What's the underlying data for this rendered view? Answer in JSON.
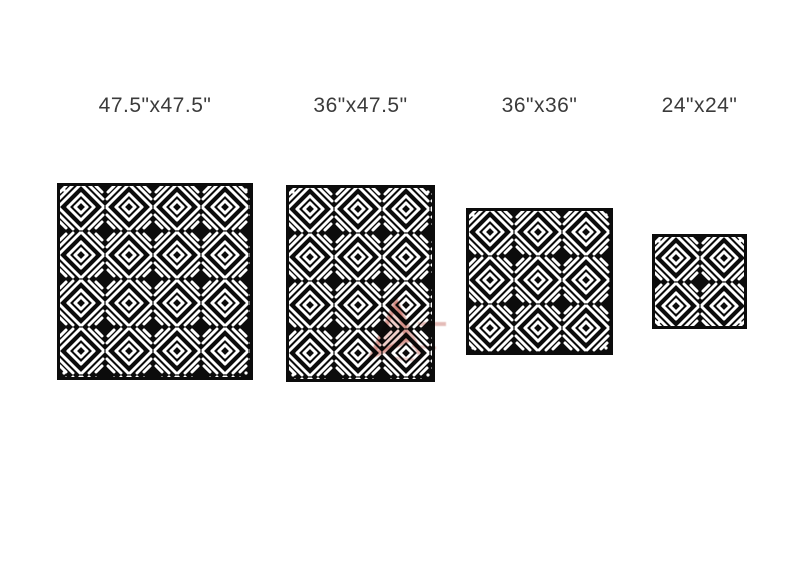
{
  "page": {
    "background": "#ffffff"
  },
  "figures": [
    {
      "label": "47.5\"x47.5\"",
      "width_in": "47.5",
      "height_in": "47.5"
    },
    {
      "label": "36\"x47.5\"",
      "width_in": "36",
      "height_in": "47.5"
    },
    {
      "label": "36\"x36\"",
      "width_in": "36",
      "height_in": "36"
    },
    {
      "label": "24\"x24\"",
      "width_in": "24",
      "height_in": "24"
    }
  ],
  "style": {
    "panel_color": "#0c0c0c",
    "cut_color": "#ffffff",
    "label_color": "#3b3b3b",
    "watermark_color": "#b03a2e",
    "watermark_fill": "rgba(190,60,45,0.30)"
  },
  "icons": {
    "watermark": "red-logo-watermark",
    "corner_dot": "mounting-hole-dot"
  }
}
